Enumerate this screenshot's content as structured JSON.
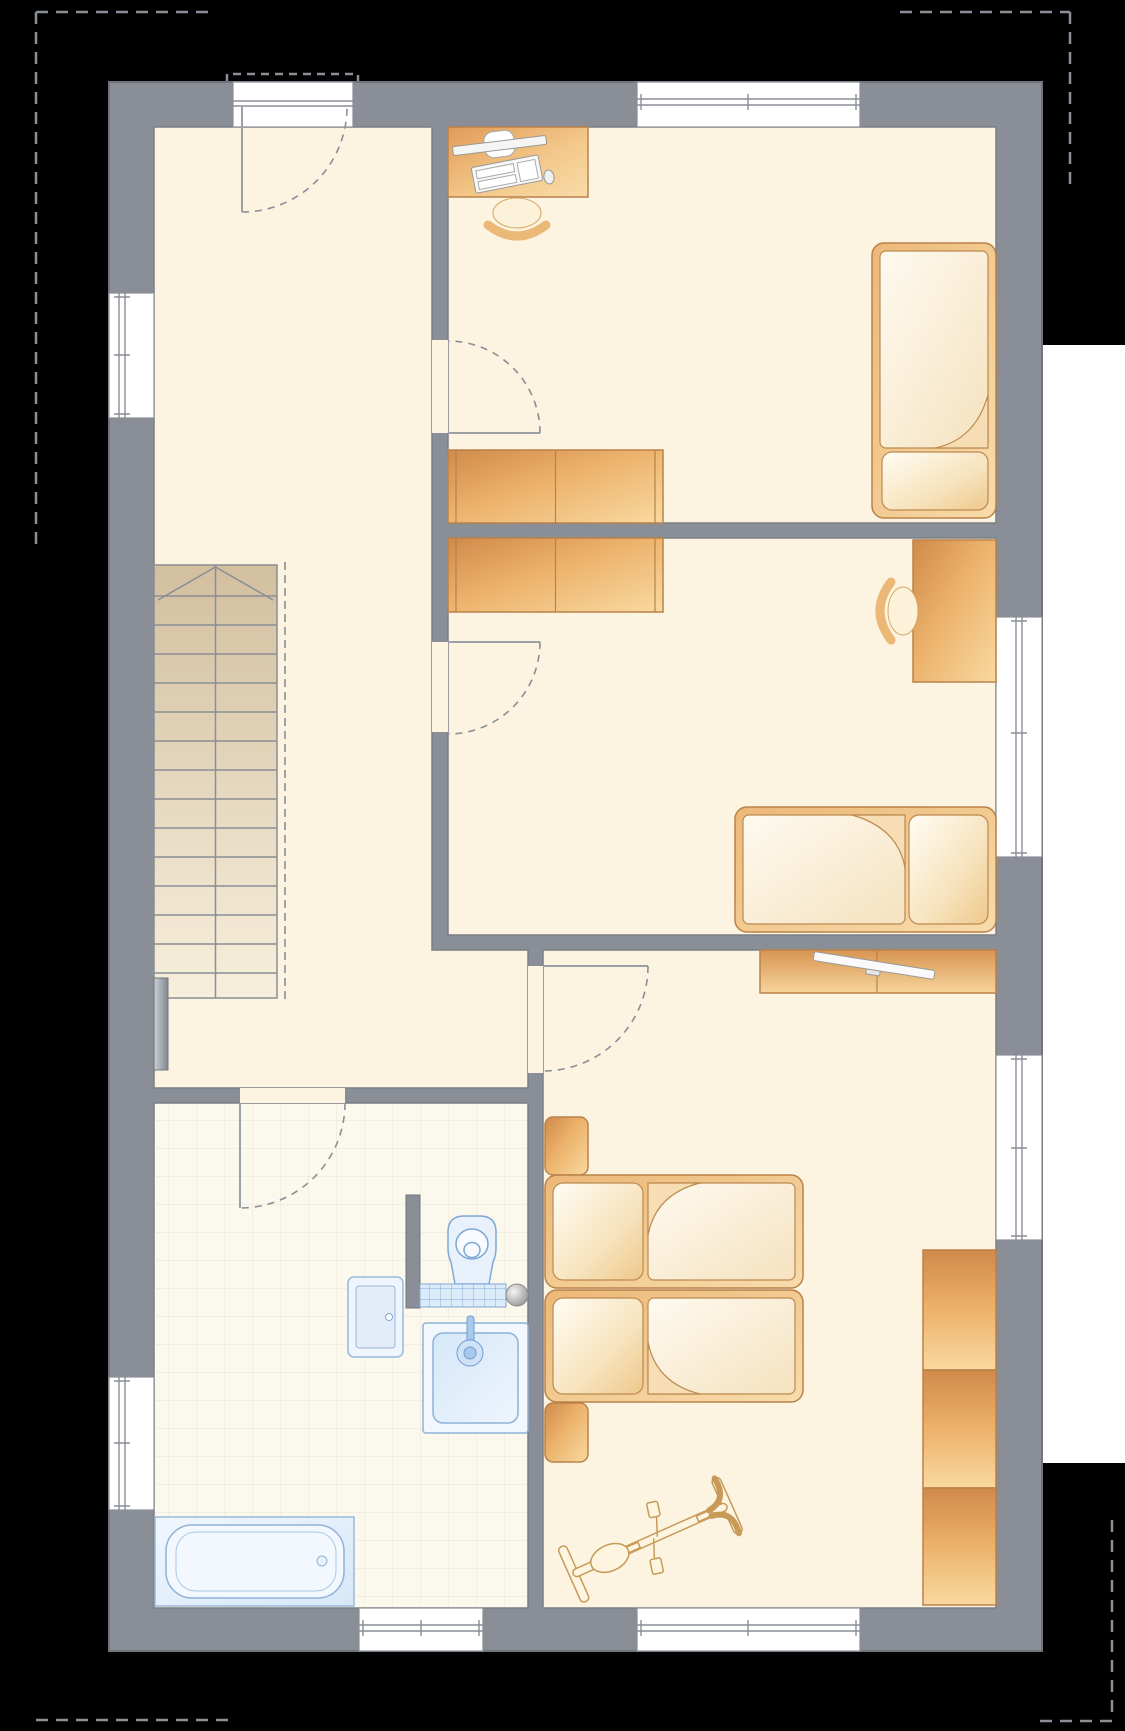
{
  "plan_type": "residential-floor-plan-top-view",
  "colors": {
    "background": "#000000",
    "outside_area": "#ffffff",
    "wall": "#8a8e96",
    "wall_outline": "#70747c",
    "floor": "#fcf4e1",
    "bathroom_floor": "#fbf8ee",
    "bathroom_tile_line": "#ebe3d1",
    "furniture_dark": "#d08a4a",
    "furniture_mid": "#ecb26b",
    "furniture_light": "#f9d9a0",
    "furniture_outline": "#b9824a",
    "bedding_light": "#fefaf0",
    "bedding_shade": "#f5e2bf",
    "fixture_blue_fill": "#e9f2fc",
    "fixture_blue_stroke": "#7fa8d4",
    "stairs_dark": "#d2bf9f",
    "stairs_light": "#f7efdc",
    "dashed_roof_line": "#8b8f97"
  },
  "rooms": [
    {
      "id": "hall",
      "contents": [
        "staircase-up",
        "radiator"
      ],
      "windows": 1,
      "doors": [
        "entrance-door",
        "bathroom-door",
        "bedroom-door",
        "child-room-1-door",
        "child-room-2-door"
      ]
    },
    {
      "id": "child-room-1",
      "contents": [
        "desk",
        "computer",
        "desk-chair",
        "wardrobe-2-section",
        "single-bed"
      ],
      "windows": 1
    },
    {
      "id": "child-room-2",
      "contents": [
        "wardrobe-2-section",
        "desk",
        "desk-chair",
        "single-bed"
      ],
      "windows": 1
    },
    {
      "id": "bedroom",
      "contents": [
        "sideboard",
        "tv",
        "nightstand",
        "double-bed-two-mattresses",
        "nightstand",
        "wardrobe-3-section",
        "exercise-bike"
      ],
      "windows": 2
    },
    {
      "id": "bathroom",
      "contents": [
        "cabinet",
        "toilet",
        "tiled-ledge",
        "floor-drain",
        "washbasin",
        "bathtub"
      ],
      "windows": 2,
      "floor": "tiled"
    }
  ],
  "staircase": {
    "treads": 15,
    "direction_arrow": "up",
    "flanked_by_dashed_void_line": true
  },
  "counts": {
    "doors_with_swing_arcs": 5,
    "windows_total": 7,
    "beds_total": 4,
    "wardrobe_units": 3
  },
  "roof_outline": {
    "style": "dashed",
    "visible_corners": [
      "top-left",
      "top-right",
      "bottom-left",
      "bottom-right"
    ],
    "entrance_canopy_dashed": true
  }
}
